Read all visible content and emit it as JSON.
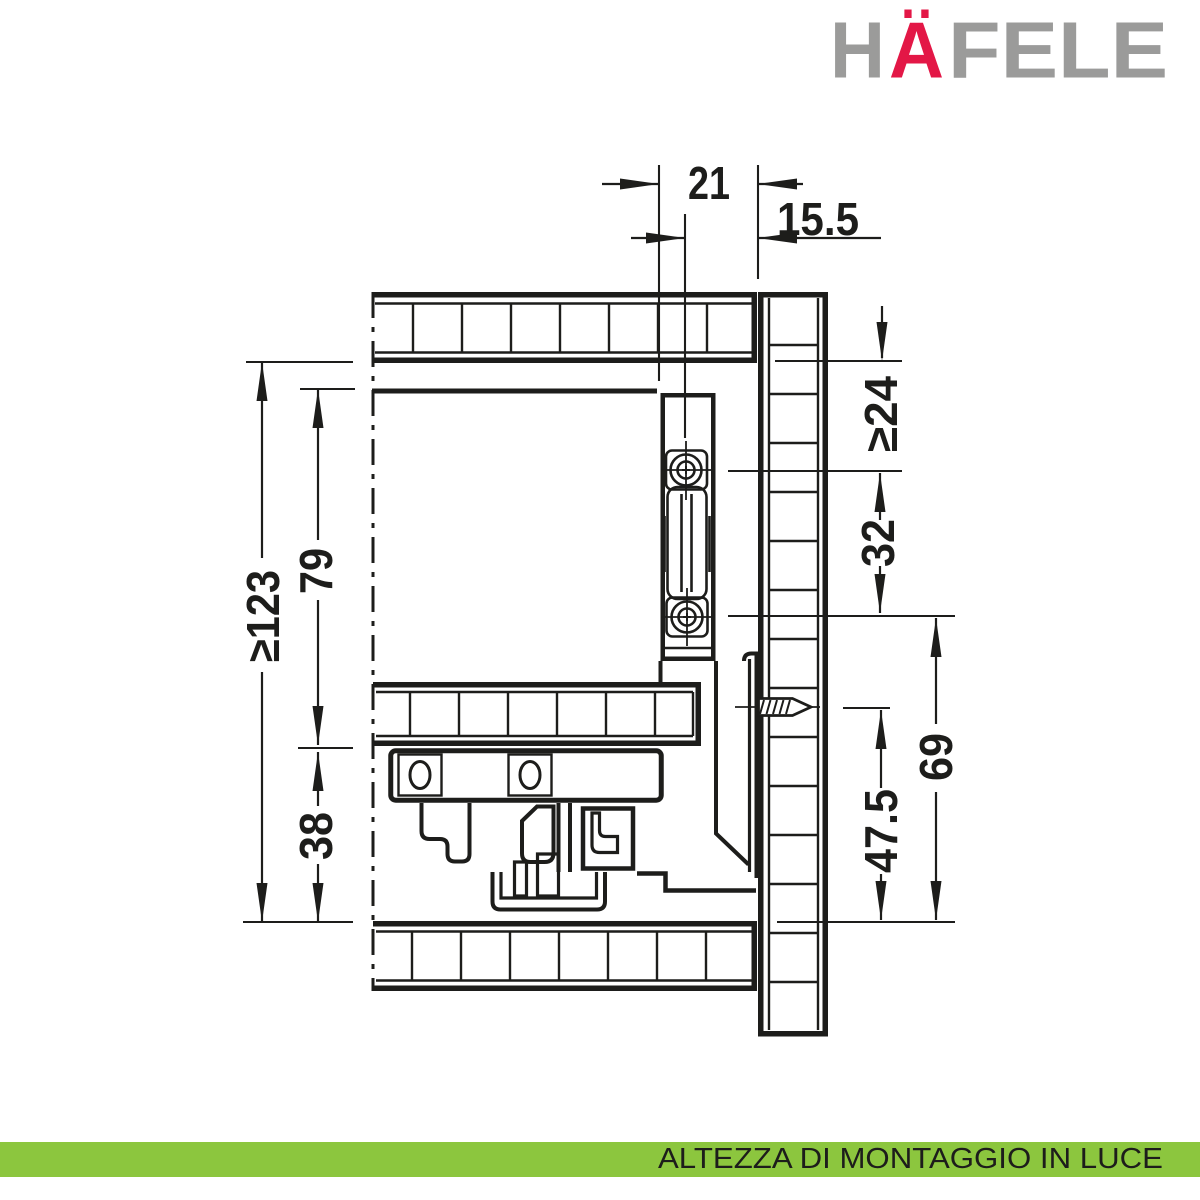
{
  "logo": {
    "h": "H",
    "a": "Ä",
    "fele": "FELE",
    "gray": "#9b9b9a",
    "red": "#e31746"
  },
  "footer": {
    "label": "ALTEZZA DI MONTAGGIO IN LUCE",
    "background": "#8cc63e",
    "text_color": "#1d1d1b"
  },
  "drawing": {
    "ink": "#1d1d1b",
    "background": "#ffffff"
  },
  "dimensions": {
    "top_width": "21",
    "top_screw_offset": "15.5",
    "clear_height": "≥123",
    "side_height": "79",
    "bottom_height": "38",
    "top_clearance": "≥24",
    "screw_spacing": "32",
    "hook_screw_height": "47.5",
    "rear_hook_height": "69"
  }
}
